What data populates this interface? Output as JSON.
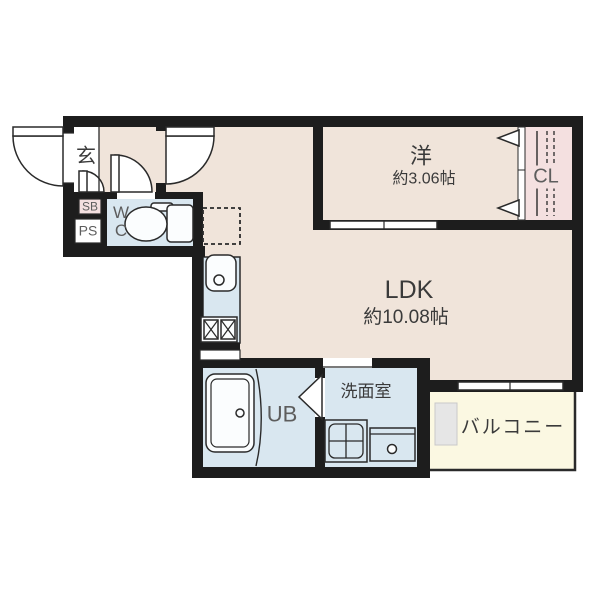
{
  "floorplan": {
    "rooms": {
      "genkan": {
        "label": "玄"
      },
      "shoe_box": {
        "label": "SB"
      },
      "pipe_space": {
        "label": "PS"
      },
      "toilet_room": {
        "line1": "W",
        "line2": "C"
      },
      "western_room": {
        "label": "洋",
        "size": "約3.06帖"
      },
      "closet": {
        "label": "CL"
      },
      "ldk": {
        "label": "LDK",
        "size": "約10.08帖"
      },
      "unit_bath": {
        "label": "UB"
      },
      "washroom": {
        "label": "洗面室"
      },
      "balcony": {
        "label": "バルコニー"
      }
    },
    "fixtures": [
      "toilet",
      "kitchen-sink",
      "gas-stove",
      "refrigerator-space",
      "bathtub",
      "washing-machine-pan",
      "vanity-sink",
      "closet-rod-and-shelf",
      "entrance-door",
      "hinged-doors",
      "folding-bath-door",
      "closet-folding-doors",
      "sliding-door",
      "balcony-window"
    ],
    "colors": {
      "wall": "#1d1d1d",
      "floor": "#f0e4da",
      "wet_area": "#d9e7f0",
      "closet_pink": "#f4e0e0",
      "balcony": "#fbf8e2",
      "outline": "#2a2a2a",
      "text": "#3a3a3a"
    }
  }
}
